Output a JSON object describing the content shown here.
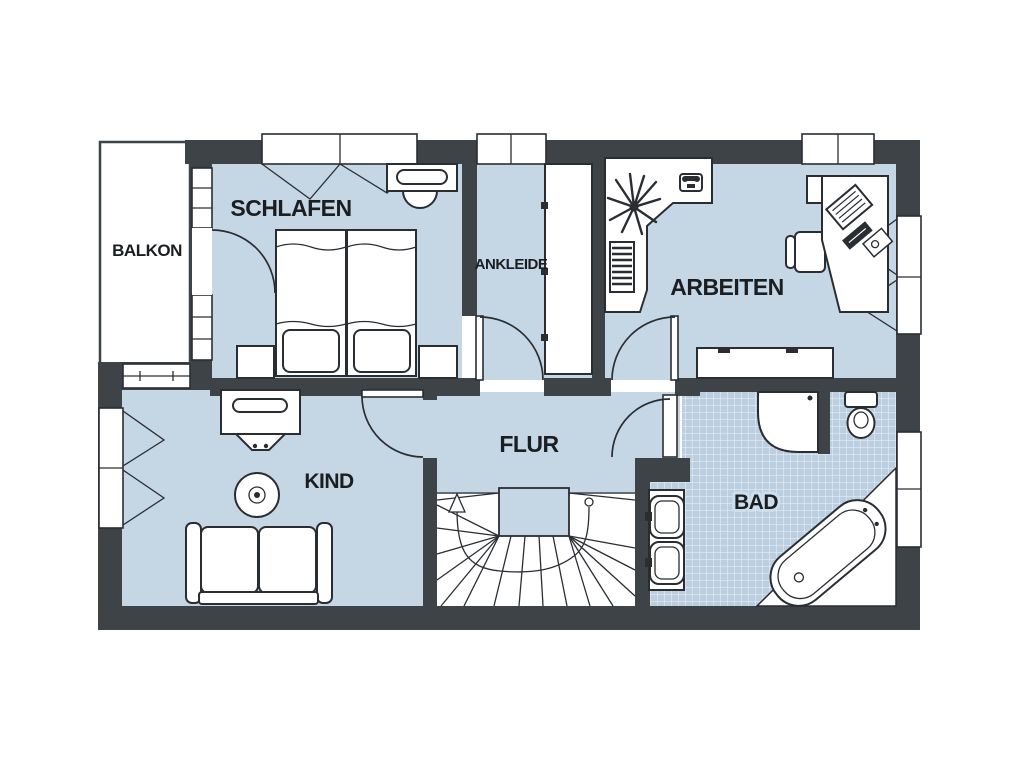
{
  "plan": {
    "rooms": {
      "balkon": {
        "label": "BALKON"
      },
      "schlafen": {
        "label": "SCHLAFEN"
      },
      "ankleide": {
        "label": "ANKLEIDE"
      },
      "arbeiten": {
        "label": "ARBEITEN"
      },
      "kind": {
        "label": "KIND"
      },
      "flur": {
        "label": "FLUR"
      },
      "bad": {
        "label": "BAD"
      }
    },
    "colors": {
      "wall": "#3e4347",
      "floor": "#c5d6e5",
      "tile": "#bccfe0",
      "line": "#2a2e33",
      "label": "#1b1e21",
      "background": "#ffffff"
    }
  }
}
